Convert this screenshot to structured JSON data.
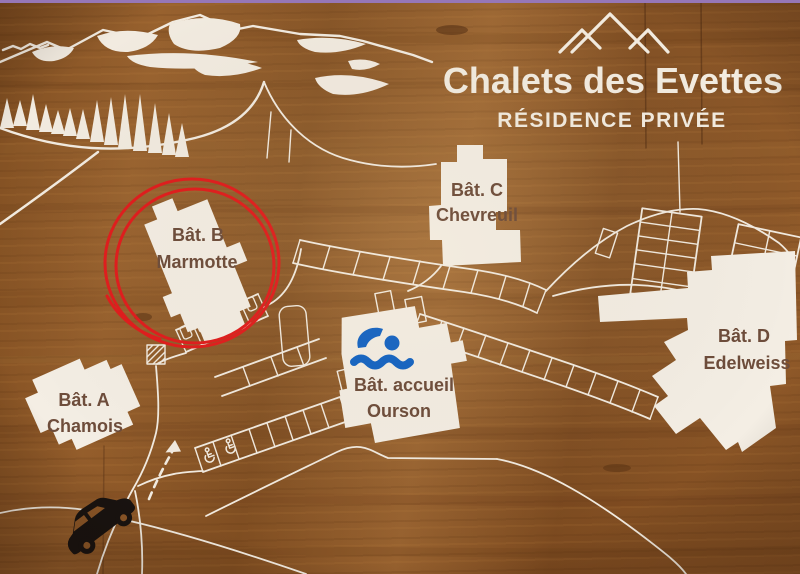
{
  "sign": {
    "title": "Chalets des Evettes",
    "subtitle": "RÉSIDENCE PRIVÉE",
    "logo": "three-mountain-peaks"
  },
  "buildings": {
    "a": {
      "name": "Bât. A",
      "sub": "Chamois"
    },
    "b": {
      "name": "Bât. B",
      "sub": "Marmotte",
      "highlight": "red-circle"
    },
    "c": {
      "name": "Bât. C",
      "sub": "Chevreuil"
    },
    "accueil": {
      "name": "Bât. accueil",
      "sub": "Ourson",
      "icon": "swimmer"
    },
    "d": {
      "name": "Bât. D",
      "sub": "Edelweiss"
    }
  },
  "icons": {
    "pool": "swimmer-icon",
    "entrance_vehicle": "car-icon",
    "accessible_parking": "wheelchair-icon",
    "direction": "dashed-arrow",
    "scenery": "mountain-ridge-and-pine-trees"
  },
  "colors": {
    "wood": "#8d5727",
    "paint_white": "#f4eee4",
    "label_brown": "#6e4d3b",
    "highlight_red": "#e11d1d",
    "pool_blue": "#1263c4",
    "car_black": "#191310",
    "photo_edge": "#9677b7"
  }
}
